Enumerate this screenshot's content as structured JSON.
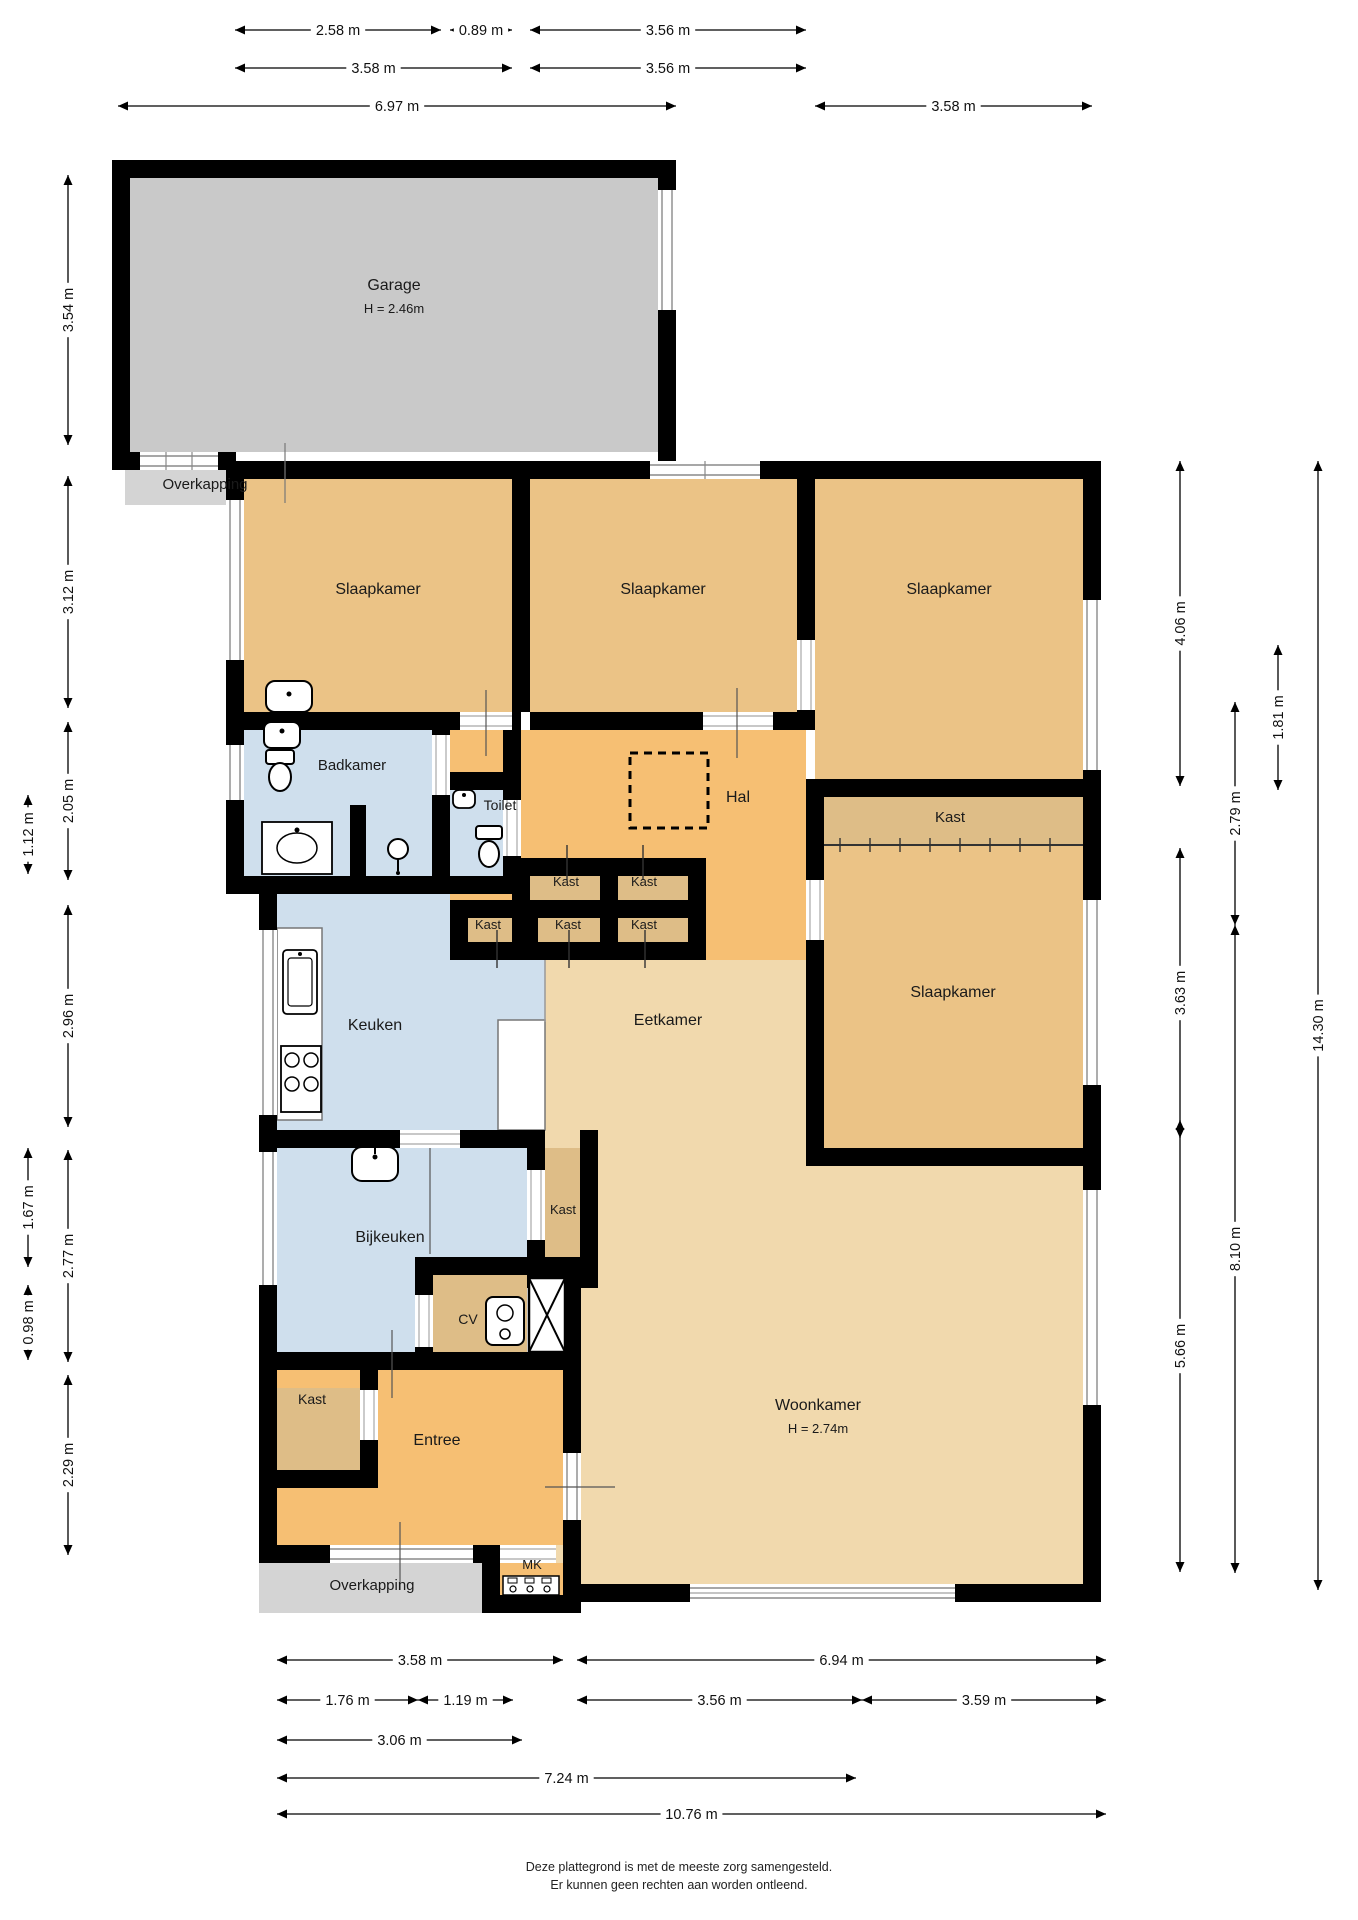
{
  "title": "Plattegrond begane grond",
  "colors": {
    "wall": "#000000",
    "garage": "#c9c9c9",
    "over": "#d4d4d4",
    "bed": "#ebc386",
    "hal": "#f6bf73",
    "living": "#f1d9ad",
    "kast": "#debd87",
    "wet": "#cfdfed",
    "dim": "#000000"
  },
  "rooms": [
    {
      "id": "garage",
      "label": "Garage",
      "note": "H = 2.46m",
      "x": 394,
      "y": 290,
      "fs": 16
    },
    {
      "id": "overkapping-top",
      "label": "Overkapping",
      "x": 205,
      "y": 489,
      "fs": 15
    },
    {
      "id": "slaapkamer-1",
      "label": "Slaapkamer",
      "x": 378,
      "y": 594,
      "fs": 16
    },
    {
      "id": "slaapkamer-2",
      "label": "Slaapkamer",
      "x": 663,
      "y": 594,
      "fs": 16
    },
    {
      "id": "slaapkamer-3",
      "label": "Slaapkamer",
      "x": 949,
      "y": 594,
      "fs": 16
    },
    {
      "id": "badkamer",
      "label": "Badkamer",
      "x": 352,
      "y": 770,
      "fs": 15
    },
    {
      "id": "toilet",
      "label": "Toilet",
      "x": 500,
      "y": 810,
      "fs": 14
    },
    {
      "id": "hal",
      "label": "Hal",
      "x": 738,
      "y": 802,
      "fs": 16
    },
    {
      "id": "kast-groot",
      "label": "Kast",
      "x": 950,
      "y": 822,
      "fs": 15
    },
    {
      "id": "slaapkamer-4",
      "label": "Slaapkamer",
      "x": 953,
      "y": 997,
      "fs": 16
    },
    {
      "id": "kast-a",
      "label": "Kast",
      "x": 566,
      "y": 886,
      "fs": 13
    },
    {
      "id": "kast-b",
      "label": "Kast",
      "x": 644,
      "y": 886,
      "fs": 13
    },
    {
      "id": "kast-c",
      "label": "Kast",
      "x": 488,
      "y": 929,
      "fs": 13
    },
    {
      "id": "kast-d",
      "label": "Kast",
      "x": 568,
      "y": 929,
      "fs": 13
    },
    {
      "id": "kast-e",
      "label": "Kast",
      "x": 644,
      "y": 929,
      "fs": 13
    },
    {
      "id": "keuken",
      "label": "Keuken",
      "x": 375,
      "y": 1030,
      "fs": 16
    },
    {
      "id": "eetkamer",
      "label": "Eetkamer",
      "x": 668,
      "y": 1025,
      "fs": 16
    },
    {
      "id": "bijkeuken",
      "label": "Bijkeuken",
      "x": 390,
      "y": 1242,
      "fs": 16
    },
    {
      "id": "kast-bijkeuken",
      "label": "Kast",
      "x": 563,
      "y": 1214,
      "fs": 13
    },
    {
      "id": "cv",
      "label": "CV",
      "x": 468,
      "y": 1324,
      "fs": 14
    },
    {
      "id": "kast-entree",
      "label": "Kast",
      "x": 312,
      "y": 1404,
      "fs": 14
    },
    {
      "id": "entree",
      "label": "Entree",
      "x": 437,
      "y": 1445,
      "fs": 16
    },
    {
      "id": "woonkamer",
      "label": "Woonkamer",
      "note": "H = 2.74m",
      "x": 818,
      "y": 1410,
      "fs": 16
    },
    {
      "id": "mk",
      "label": "MK",
      "x": 532,
      "y": 1569,
      "fs": 13
    },
    {
      "id": "overkapping-bottom",
      "label": "Overkapping",
      "x": 372,
      "y": 1590,
      "fs": 15
    }
  ],
  "dimensions": {
    "top": [
      {
        "label": "2.58 m",
        "a": 235,
        "b": 441,
        "pos": 30
      },
      {
        "label": "0.89 m",
        "a": 450,
        "b": 512,
        "pos": 30
      },
      {
        "label": "3.56 m",
        "a": 530,
        "b": 806,
        "pos": 30
      },
      {
        "label": "3.58 m",
        "a": 235,
        "b": 512,
        "pos": 68
      },
      {
        "label": "3.56 m",
        "a": 530,
        "b": 806,
        "pos": 68
      },
      {
        "label": "6.97 m",
        "a": 118,
        "b": 676,
        "pos": 106
      },
      {
        "label": "3.58 m",
        "a": 815,
        "b": 1092,
        "pos": 106
      }
    ],
    "left": [
      {
        "label": "3.54 m",
        "a": 175,
        "b": 445,
        "pos": 68
      },
      {
        "label": "3.12 m",
        "a": 476,
        "b": 708,
        "pos": 68
      },
      {
        "label": "2.05 m",
        "a": 722,
        "b": 880,
        "pos": 68
      },
      {
        "label": "1.12 m",
        "a": 795,
        "b": 874,
        "pos": 28
      },
      {
        "label": "2.96 m",
        "a": 905,
        "b": 1127,
        "pos": 68
      },
      {
        "label": "1.67 m",
        "a": 1148,
        "b": 1267,
        "pos": 28
      },
      {
        "label": "2.77 m",
        "a": 1150,
        "b": 1362,
        "pos": 68
      },
      {
        "label": "0.98 m",
        "a": 1285,
        "b": 1360,
        "pos": 28
      },
      {
        "label": "2.29 m",
        "a": 1375,
        "b": 1555,
        "pos": 68
      }
    ],
    "right": [
      {
        "label": "4.06 m",
        "a": 461,
        "b": 786,
        "pos": 1180
      },
      {
        "label": "2.79 m",
        "a": 702,
        "b": 925,
        "pos": 1235
      },
      {
        "label": "1.81 m",
        "a": 645,
        "b": 790,
        "pos": 1278
      },
      {
        "label": "3.63 m",
        "a": 848,
        "b": 1138,
        "pos": 1180
      },
      {
        "label": "8.10 m",
        "a": 925,
        "b": 1573,
        "pos": 1235
      },
      {
        "label": "5.66 m",
        "a": 1120,
        "b": 1572,
        "pos": 1180
      },
      {
        "label": "14.30 m",
        "a": 461,
        "b": 1590,
        "pos": 1318
      }
    ],
    "bottom": [
      {
        "label": "3.58 m",
        "a": 277,
        "b": 563,
        "pos": 1660
      },
      {
        "label": "6.94 m",
        "a": 577,
        "b": 1106,
        "pos": 1660
      },
      {
        "label": "1.76 m",
        "a": 277,
        "b": 418,
        "pos": 1700
      },
      {
        "label": "1.19 m",
        "a": 418,
        "b": 513,
        "pos": 1700
      },
      {
        "label": "3.56 m",
        "a": 577,
        "b": 862,
        "pos": 1700
      },
      {
        "label": "3.59 m",
        "a": 862,
        "b": 1106,
        "pos": 1700
      },
      {
        "label": "3.06 m",
        "a": 277,
        "b": 522,
        "pos": 1740
      },
      {
        "label": "7.24 m",
        "a": 277,
        "b": 856,
        "pos": 1778
      },
      {
        "label": "10.76 m",
        "a": 277,
        "b": 1106,
        "pos": 1814
      }
    ]
  },
  "footer": {
    "line1": "Deze plattegrond is met de meeste zorg samengesteld.",
    "line2": "Er kunnen geen rechten aan worden ontleend."
  }
}
